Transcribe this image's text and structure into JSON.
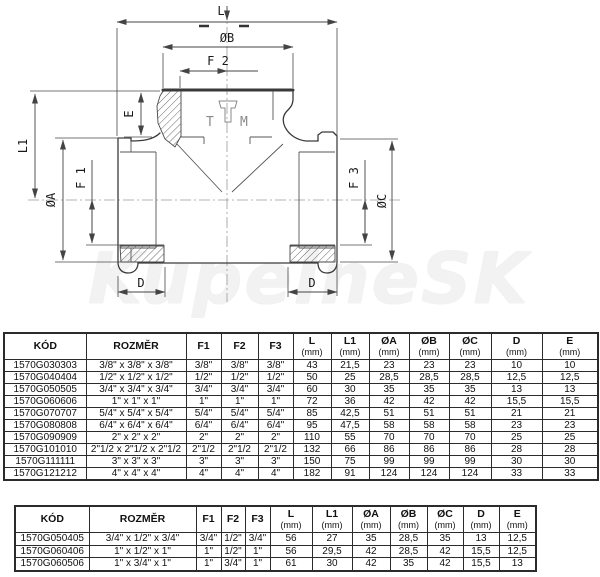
{
  "diagram": {
    "labels": {
      "l": "L",
      "ob": "ØB",
      "f2": "F 2",
      "e": "E",
      "l1": "L1",
      "f1": "F 1",
      "oa": "ØA",
      "f3": "F 3",
      "oc": "ØC",
      "d_left": "D",
      "d_right": "D"
    },
    "logo": {
      "t": "T",
      "m": "M"
    },
    "watermark": "KupelneSK"
  },
  "table1": {
    "headers": [
      {
        "label": "KÓD"
      },
      {
        "label": "ROZMĚR"
      },
      {
        "label": "F1"
      },
      {
        "label": "F2"
      },
      {
        "label": "F3"
      },
      {
        "label": "L",
        "unit": "(mm)"
      },
      {
        "label": "L1",
        "unit": "(mm)"
      },
      {
        "label": "ØA",
        "unit": "(mm)"
      },
      {
        "label": "ØB",
        "unit": "(mm)"
      },
      {
        "label": "ØC",
        "unit": "(mm)"
      },
      {
        "label": "D",
        "unit": "(mm)"
      },
      {
        "label": "E",
        "unit": "(mm)"
      }
    ],
    "rows": [
      [
        "1570G030303",
        "3/8\" x 3/8\" x 3/8\"",
        "3/8\"",
        "3/8\"",
        "3/8\"",
        "43",
        "21,5",
        "23",
        "23",
        "23",
        "10",
        "10"
      ],
      [
        "1570G040404",
        "1/2\" x 1/2\" x 1/2\"",
        "1/2\"",
        "1/2\"",
        "1/2\"",
        "50",
        "25",
        "28,5",
        "28,5",
        "28,5",
        "12,5",
        "12,5"
      ],
      [
        "1570G050505",
        "3/4\" x 3/4\" x 3/4\"",
        "3/4\"",
        "3/4\"",
        "3/4\"",
        "60",
        "30",
        "35",
        "35",
        "35",
        "13",
        "13"
      ],
      [
        "1570G060606",
        "1\" x 1\" x 1\"",
        "1\"",
        "1\"",
        "1\"",
        "72",
        "36",
        "42",
        "42",
        "42",
        "15,5",
        "15,5"
      ],
      [
        "1570G070707",
        "5/4\" x 5/4\" x 5/4\"",
        "5/4\"",
        "5/4\"",
        "5/4\"",
        "85",
        "42,5",
        "51",
        "51",
        "51",
        "21",
        "21"
      ],
      [
        "1570G080808",
        "6/4\" x 6/4\" x 6/4\"",
        "6/4\"",
        "6/4\"",
        "6/4\"",
        "95",
        "47,5",
        "58",
        "58",
        "58",
        "23",
        "23"
      ],
      [
        "1570G090909",
        "2\" x 2\" x 2\"",
        "2\"",
        "2\"",
        "2\"",
        "110",
        "55",
        "70",
        "70",
        "70",
        "25",
        "25"
      ],
      [
        "1570G101010",
        "2\"1/2 x 2\"1/2 x 2\"1/2",
        "2\"1/2",
        "2\"1/2",
        "2\"1/2",
        "132",
        "66",
        "86",
        "86",
        "86",
        "28",
        "28"
      ],
      [
        "1570G111111",
        "3\" x 3\" x 3\"",
        "3\"",
        "3\"",
        "3\"",
        "150",
        "75",
        "99",
        "99",
        "99",
        "30",
        "30"
      ],
      [
        "1570G121212",
        "4\" x 4\" x 4\"",
        "4\"",
        "4\"",
        "4\"",
        "182",
        "91",
        "124",
        "124",
        "124",
        "33",
        "33"
      ]
    ]
  },
  "table2": {
    "headers": [
      {
        "label": "KÓD"
      },
      {
        "label": "ROZMĚR"
      },
      {
        "label": "F1"
      },
      {
        "label": "F2"
      },
      {
        "label": "F3"
      },
      {
        "label": "L",
        "unit": "(mm)"
      },
      {
        "label": "L1",
        "unit": "(mm)"
      },
      {
        "label": "ØA",
        "unit": "(mm)"
      },
      {
        "label": "ØB",
        "unit": "(mm)"
      },
      {
        "label": "ØC",
        "unit": "(mm)"
      },
      {
        "label": "D",
        "unit": "(mm)"
      },
      {
        "label": "E",
        "unit": "(mm)"
      }
    ],
    "rows": [
      [
        "1570G050405",
        "3/4\" x 1/2\" x 3/4\"",
        "3/4\"",
        "1/2\"",
        "3/4\"",
        "56",
        "27",
        "35",
        "28,5",
        "35",
        "13",
        "12,5"
      ],
      [
        "1570G060406",
        "1\" x 1/2\" x 1\"",
        "1\"",
        "1/2\"",
        "1\"",
        "56",
        "29,5",
        "42",
        "28,5",
        "42",
        "15,5",
        "12,5"
      ],
      [
        "1570G060506",
        "1\" x 3/4\" x 1\"",
        "1\"",
        "3/4\"",
        "1\"",
        "61",
        "30",
        "42",
        "35",
        "42",
        "15,5",
        "13"
      ]
    ]
  }
}
